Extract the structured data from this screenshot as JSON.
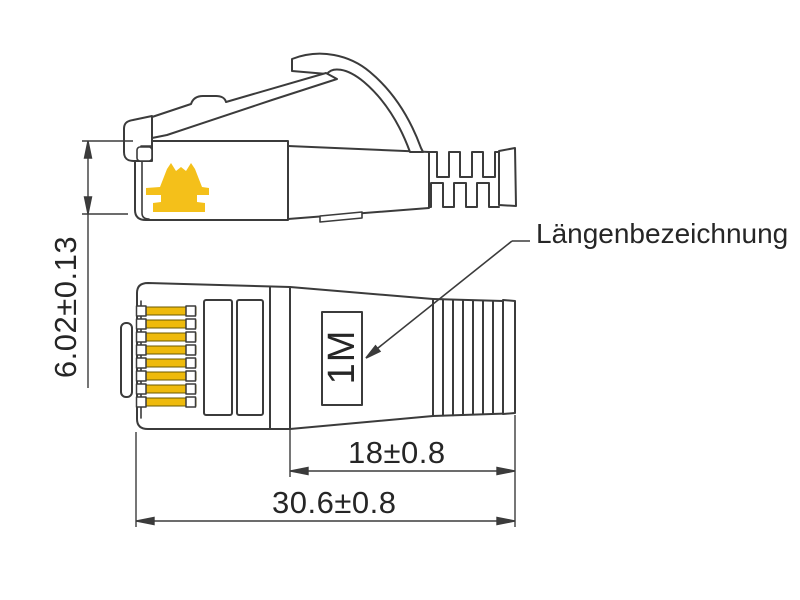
{
  "drawing": {
    "label_length_designation": "Längenbezeichnung",
    "length_marking": "1M",
    "dimensions": {
      "plug_height": "6.02±0.13",
      "boot_length": "18±0.8",
      "total_length": "30.6±0.8"
    }
  },
  "colors": {
    "line": "#3b3b3b",
    "text": "#262626",
    "pin-gold": "#eeba0c",
    "clip-yellow": "#f4c01a",
    "paper": "#ffffff"
  }
}
